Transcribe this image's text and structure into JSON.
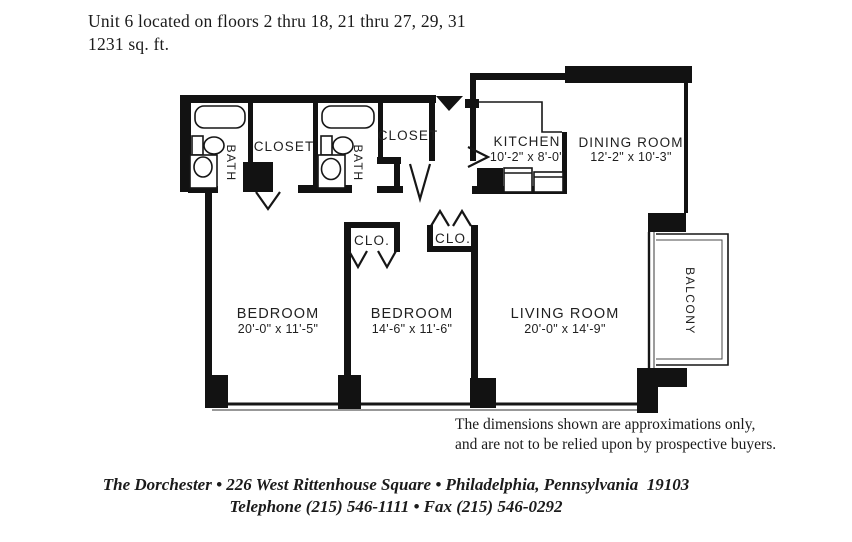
{
  "header": {
    "line1": "Unit 6 located on floors 2 thru 18, 21 thru 27, 29, 31",
    "line2": "1231 sq. ft."
  },
  "floor_plan": {
    "rooms": {
      "bath1": {
        "label": "BATH"
      },
      "bath2": {
        "label": "BATH"
      },
      "closet1": {
        "label": "CLOSET"
      },
      "closet2": {
        "label": "CLOSET"
      },
      "kitchen": {
        "label": "KITCHEN",
        "dimensions": "10'-2\" x 8'-0\""
      },
      "dining": {
        "label": "DINING ROOM",
        "dimensions": "12'-2\" x 10'-3\""
      },
      "clo1": {
        "label": "CLO."
      },
      "clo2": {
        "label": "CLO."
      },
      "bedroom1": {
        "label": "BEDROOM",
        "dimensions": "20'-0\" x 11'-5\""
      },
      "bedroom2": {
        "label": "BEDROOM",
        "dimensions": "14'-6\" x 11'-6\""
      },
      "living": {
        "label": "LIVING ROOM",
        "dimensions": "20'-0\" x 14'-9\""
      },
      "balcony": {
        "label": "BALCONY"
      }
    }
  },
  "disclaimer": {
    "line1": "The dimensions shown are approximations only,",
    "line2": "and are not to be relied upon by prospective buyers."
  },
  "footer": {
    "line1": "The Dorchester • 226 West Rittenhouse Square • Philadelphia, Pennsylvania  19103",
    "line2": "Telephone (215) 546-1111 • Fax (215) 546-0292"
  },
  "colors": {
    "wall_ink": "#121212",
    "text_ink": "#1b1b1b",
    "paper": "#ffffff"
  }
}
